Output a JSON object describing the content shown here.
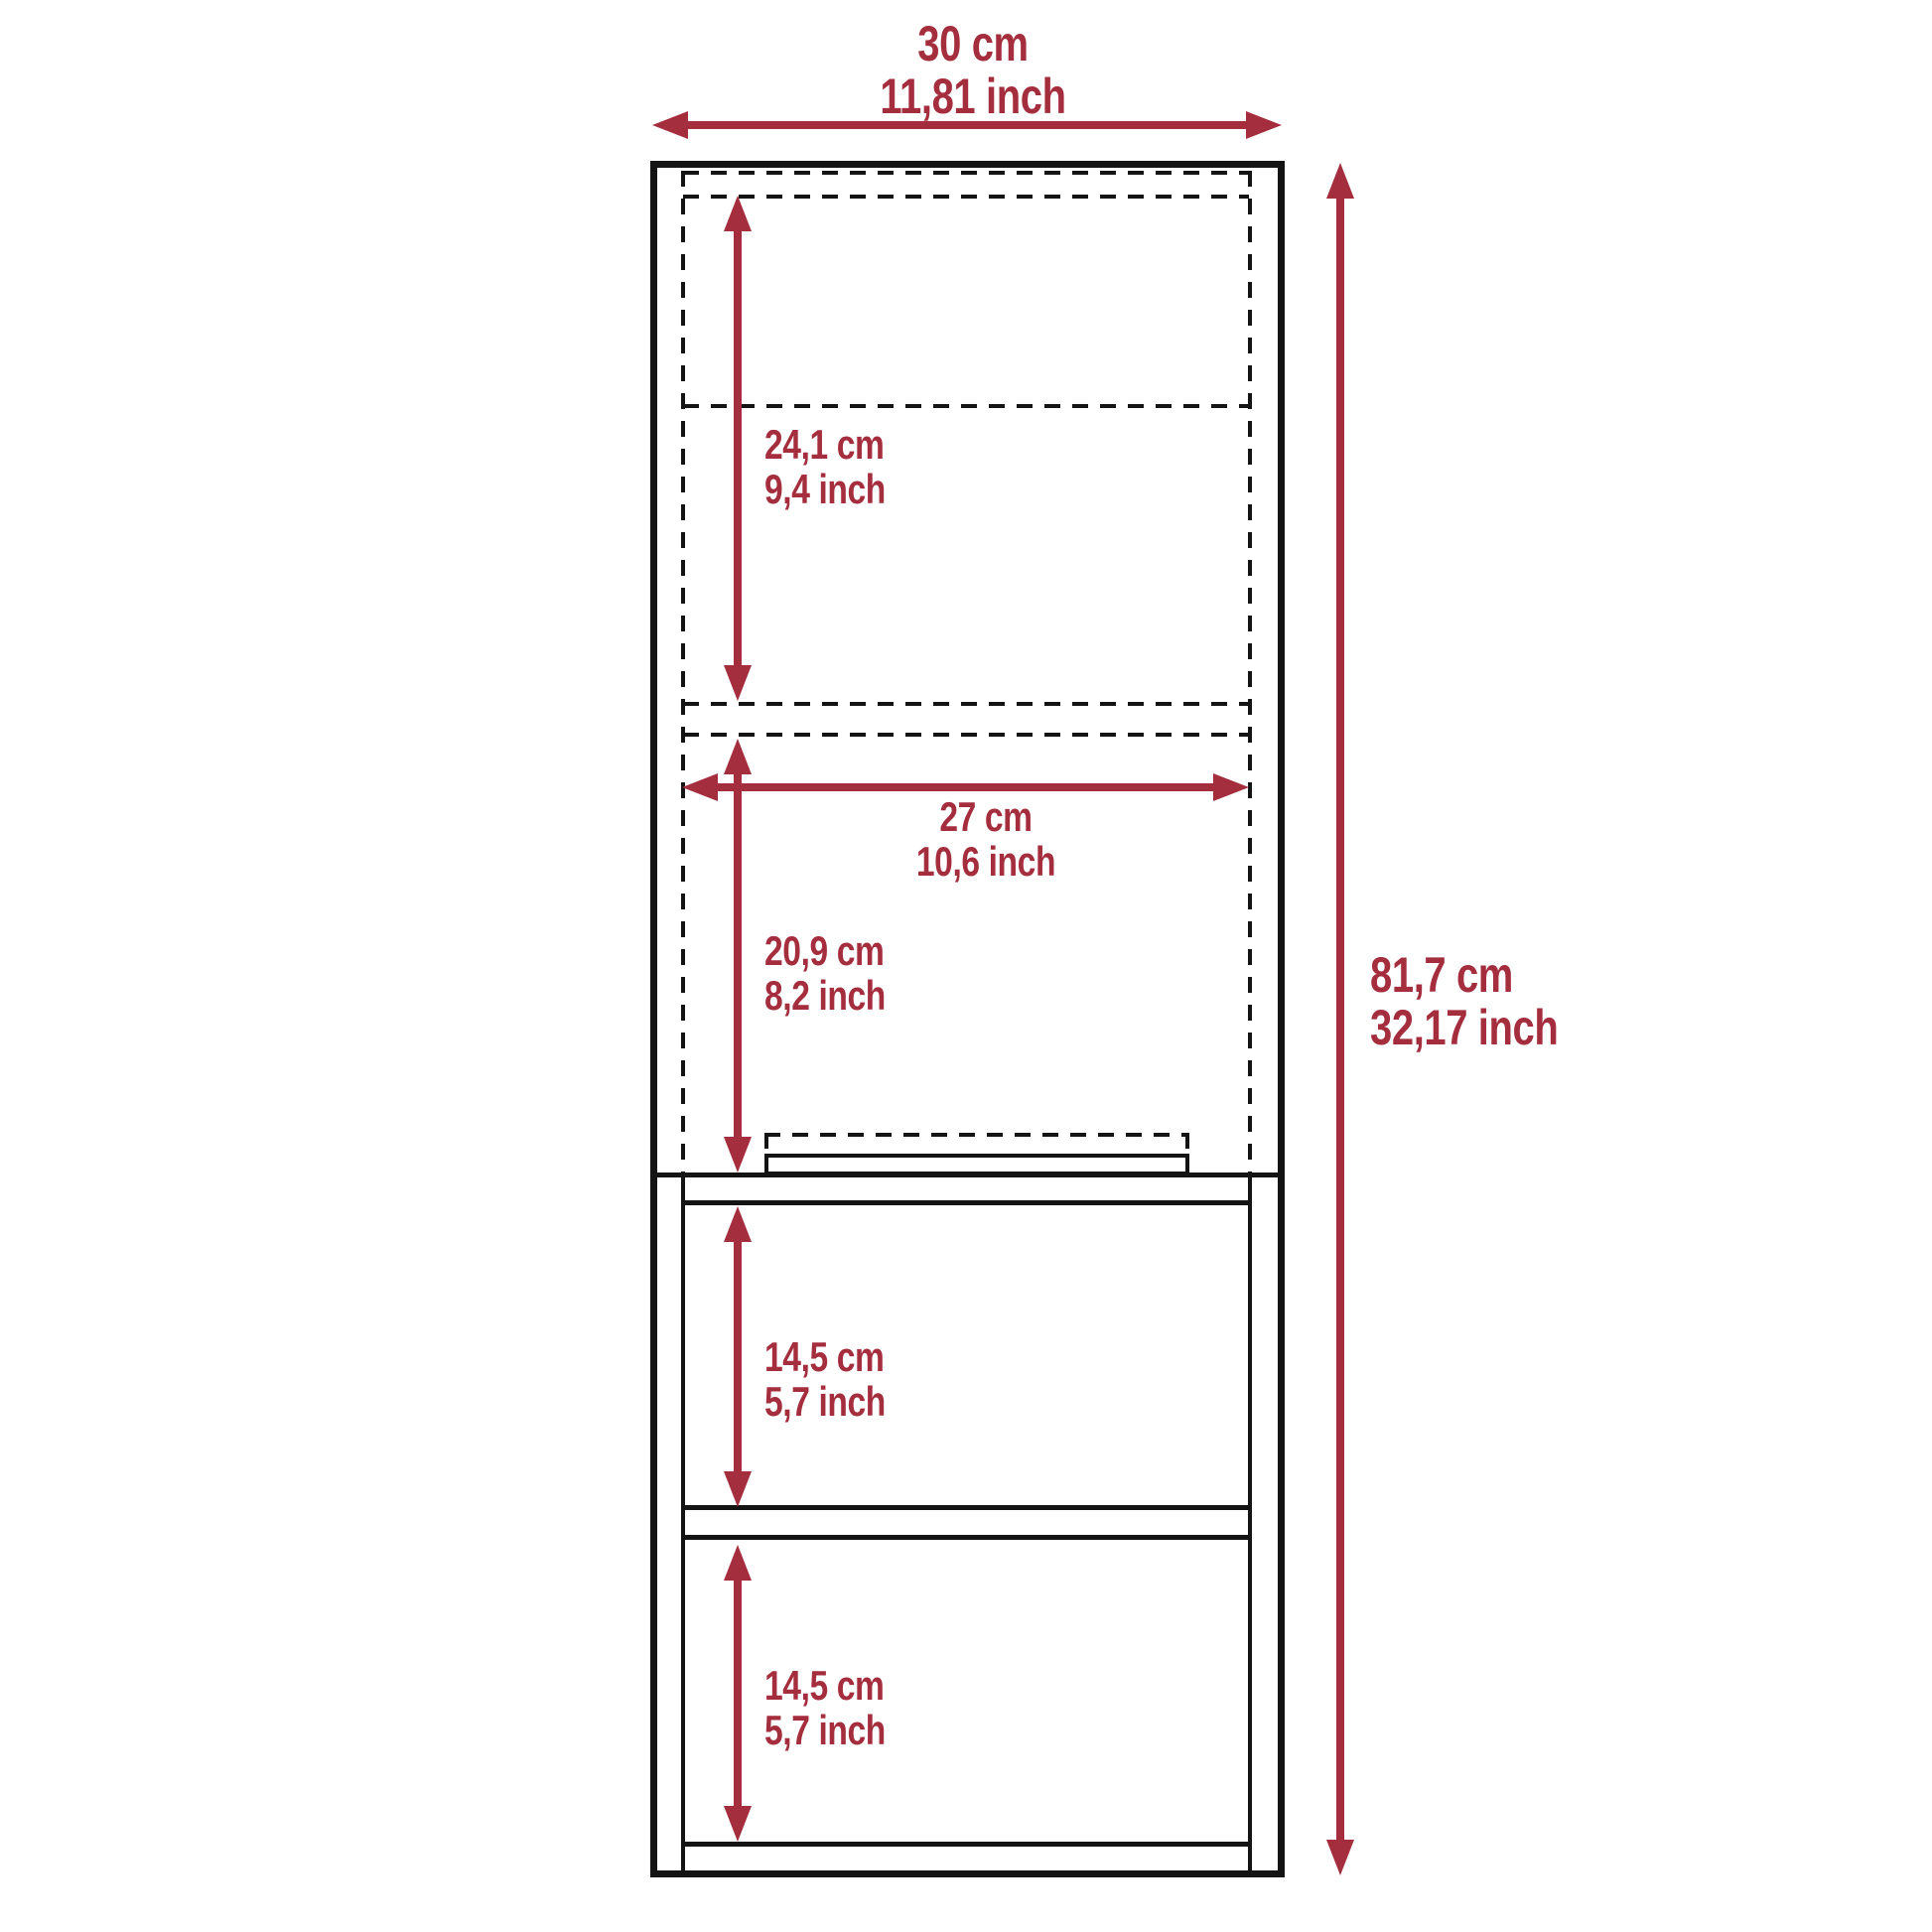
{
  "diagram": {
    "accent_color": "#A52E3E",
    "line_color": "#141414",
    "labels": {
      "overall_width": {
        "cm": "30 cm",
        "inch": "11,81 inch"
      },
      "overall_height": {
        "cm": "81,7 cm",
        "inch": "32,17 inch"
      },
      "upper_compartment": {
        "cm": "24,1 cm",
        "inch": "9,4 inch"
      },
      "inner_width": {
        "cm": "27 cm",
        "inch": "10,6 inch"
      },
      "lower_door_section": {
        "cm": "20,9 cm",
        "inch": "8,2 inch"
      },
      "middle_shelf_opening": {
        "cm": "14,5 cm",
        "inch": "5,7 inch"
      },
      "bottom_shelf_opening": {
        "cm": "14,5 cm",
        "inch": "5,7 inch"
      }
    }
  }
}
